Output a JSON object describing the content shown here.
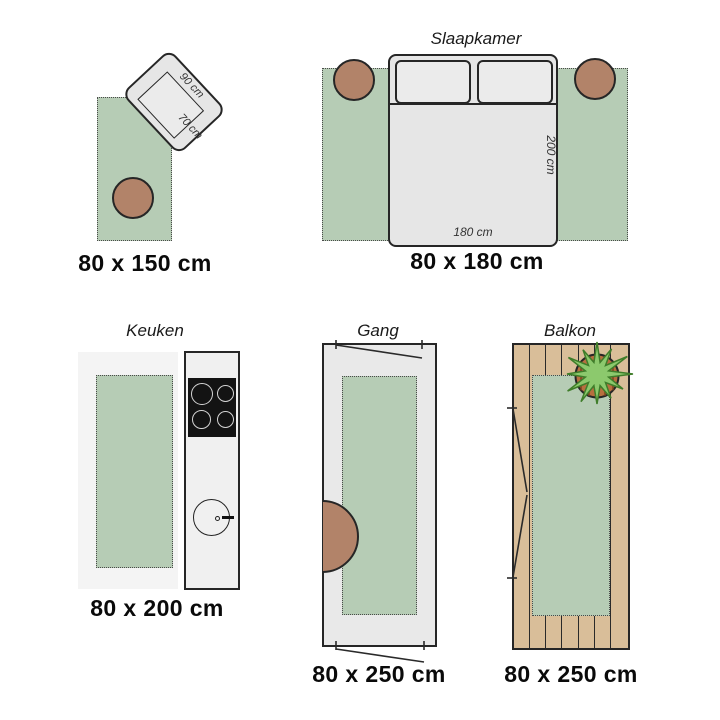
{
  "panels": {
    "rug150": {
      "caption": "80 x 150 cm",
      "chair": {
        "width_label": "90 cm",
        "depth_label": "70 cm"
      }
    },
    "bedroom": {
      "title": "Slaapkamer",
      "caption": "80 x 180 cm",
      "bed": {
        "width_label": "180 cm",
        "length_label": "200 cm"
      }
    },
    "kitchen": {
      "title": "Keuken",
      "caption": "80 x 200 cm"
    },
    "hallway": {
      "title": "Gang",
      "caption": "80 x 250 cm"
    },
    "balcony": {
      "title": "Balkon",
      "caption": "80 x 250 cm"
    }
  },
  "colors": {
    "rug_green": "#b6ccb5",
    "pouf_brown": "#b28369",
    "furniture_gray": "#e6e6e6",
    "floor_gray": "#f4f4f4",
    "hall_gray": "#e9e9e9",
    "counter_gray": "#f0f0f0",
    "wood_tan": "#d9be99",
    "pot_terracotta": "#b76f3f",
    "plant_green": "#8cc96d",
    "cooktop_black": "#131313",
    "outline": "#262626"
  }
}
